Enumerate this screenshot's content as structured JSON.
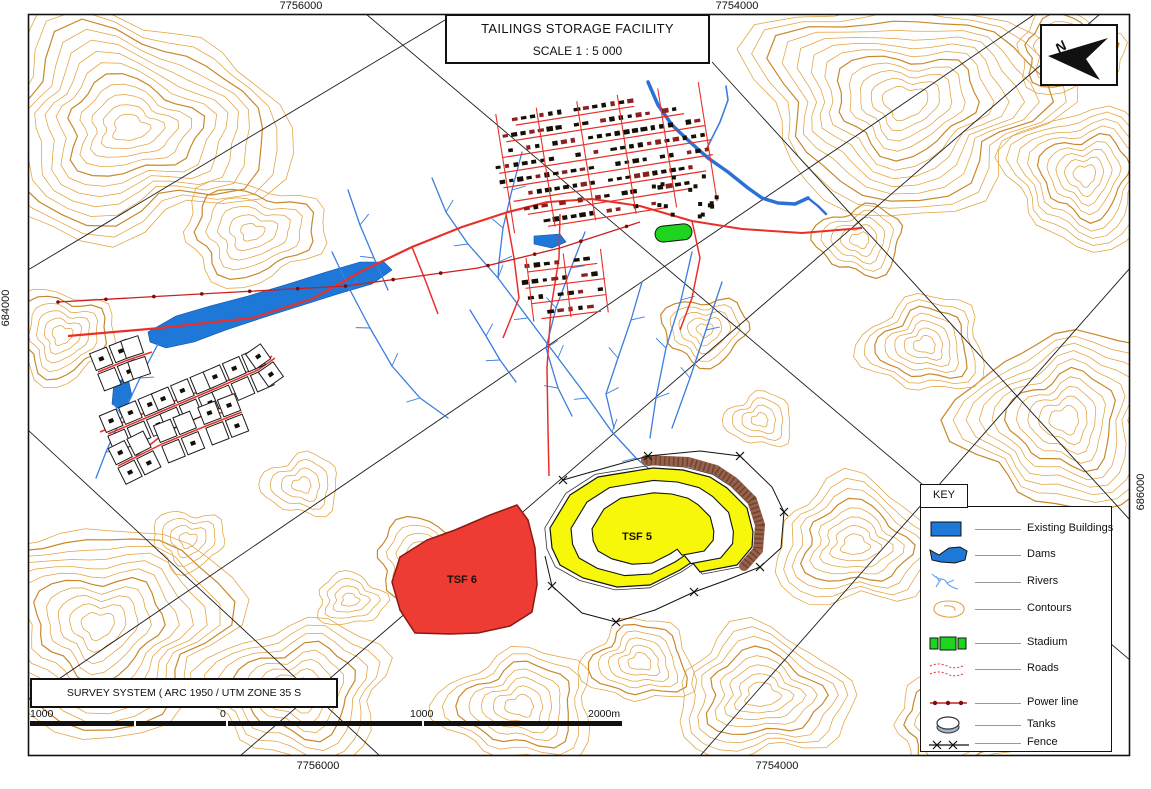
{
  "title_box": {
    "title": "TAILINGS STORAGE FACILITY",
    "scale": "SCALE 1 : 5 000"
  },
  "grid_labels": {
    "top_left": "7756000",
    "top_right": "7754000",
    "bottom_left": "7756000",
    "bottom_right": "7754000",
    "left": "684000",
    "right": "686000"
  },
  "north_arrow": {
    "label": "N"
  },
  "map_features": {
    "tsf5_label": "TSF 5",
    "tsf6_label": "TSF 6"
  },
  "key": {
    "title": "KEY",
    "items": [
      {
        "symbol": "existing-buildings",
        "label": "Existing Buildings"
      },
      {
        "symbol": "dams",
        "label": "Dams"
      },
      {
        "symbol": "rivers",
        "label": "Rivers"
      },
      {
        "symbol": "contours",
        "label": "Contours"
      },
      {
        "symbol": "stadium",
        "label": "Stadium"
      },
      {
        "symbol": "roads",
        "label": "Roads"
      },
      {
        "symbol": "power-line",
        "label": "Power line"
      },
      {
        "symbol": "tanks",
        "label": "Tanks"
      },
      {
        "symbol": "fence",
        "label": "Fence"
      }
    ]
  },
  "survey_box": {
    "text": "SURVEY SYSTEM ( ARC 1950 / UTM ZONE 35 S"
  },
  "scale_bar": {
    "labels": [
      "1000",
      "0",
      "1000",
      "2000m"
    ]
  },
  "colors": {
    "contour": "#E2A23E",
    "contour_index": "#C8882A",
    "river": "#3B7DDE",
    "river_main": "#2B6FD8",
    "dam": "#1E78D8",
    "road": "#E8302A",
    "power_line": "#CC1F1F",
    "power_dot": "#7A0C0C",
    "stadium": "#1FD41F",
    "tsf5_fill": "#F7F70A",
    "tsf6_fill": "#EE3B33",
    "tsf5_rim": "#96604A",
    "tsf5_rim_dark": "#6E4430",
    "building": "#151005",
    "building_alt": "#8B2020",
    "boundary": "#1A1A1A"
  }
}
